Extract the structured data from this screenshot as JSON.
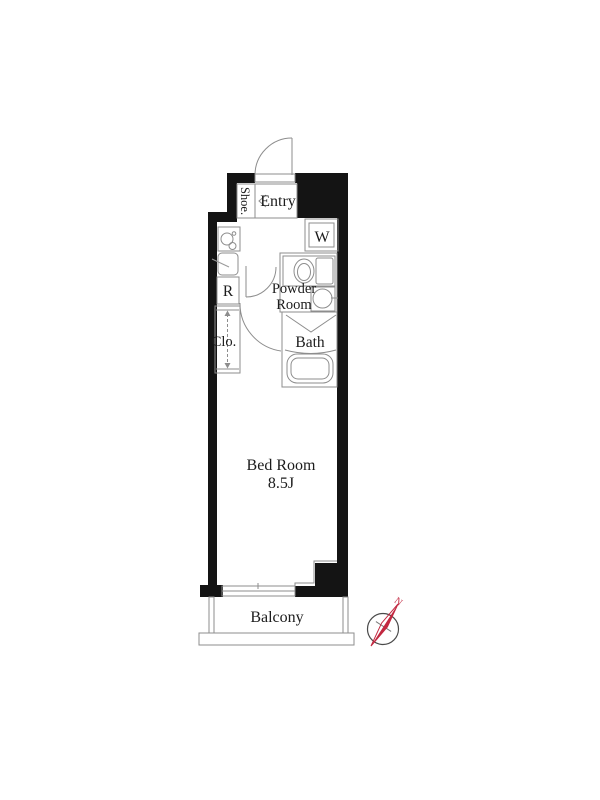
{
  "floorplan": {
    "rooms": {
      "entry": {
        "label": "Entry"
      },
      "shoe": {
        "label": "Shoe."
      },
      "washer": {
        "label": "W"
      },
      "powder": {
        "line1": "Powder",
        "line2": "Room"
      },
      "bath": {
        "label": "Bath"
      },
      "fridge": {
        "label": "R"
      },
      "closet": {
        "label": "Clo."
      },
      "bedroom": {
        "name": "Bed Room",
        "size": "8.5J"
      },
      "balcony": {
        "label": "Balcony"
      }
    },
    "compass": {
      "north": "N"
    },
    "colors": {
      "wall": "#141414",
      "line": "#8d8d8d",
      "text": "#1c1c1c",
      "compass_needle": "#c22840",
      "background": "#ffffff"
    }
  }
}
